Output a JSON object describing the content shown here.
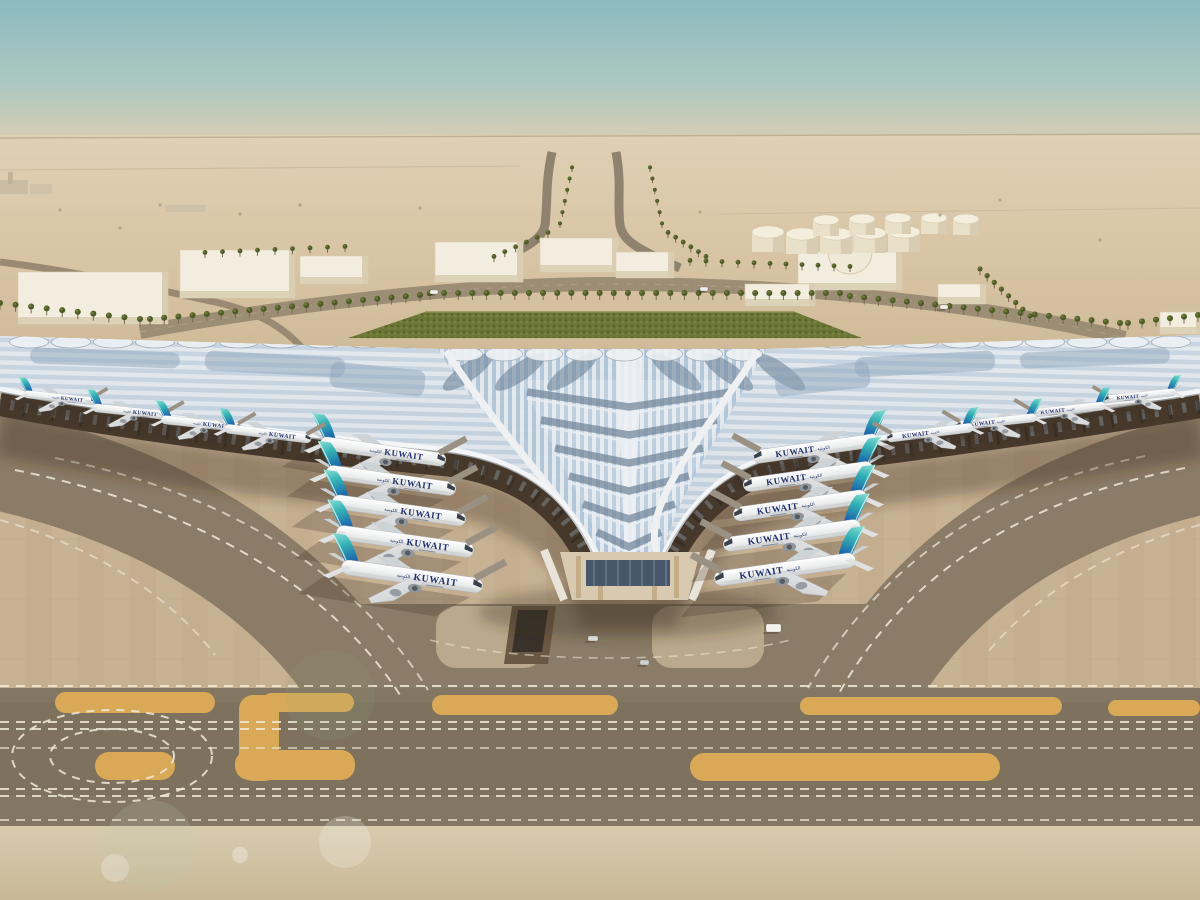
{
  "scene": {
    "title": "Aerial architectural rendering of Kuwait International Airport Terminal 2",
    "time_of_day": "day, hazy desert light",
    "view": "elevated aerial, terminal trefoil roof with aircraft at gates"
  },
  "colors": {
    "sky_top": "#8cbac0",
    "sky_horizon": "#ddd0b9",
    "desert_light": "#dfcfb2",
    "desert_mid": "#d2bd9c",
    "apron_light": "#c6b192",
    "apron_dark": "#8a7c66",
    "taxiway_band": "#837663",
    "paint_orange": "#d9a958",
    "marking_white": "#f0ead9",
    "roof_silver": "#e9edf0",
    "roof_glass_blue": "#a9c2dc",
    "roof_slate": "#6e8295",
    "tail_teal": "#35b3b6",
    "tail_blue": "#1d66ab",
    "livery_navy": "#20306d",
    "greenery": "#6c7636"
  },
  "aircraft": {
    "label": "KUWAIT",
    "label_arabic": "الكويتية",
    "fleets": [
      {
        "name": "left-gates",
        "dir": "right",
        "layer": "planes-main",
        "items": [
          {
            "x": 383,
            "y": 452,
            "r": 8,
            "s": 0.96
          },
          {
            "x": 391,
            "y": 481,
            "r": 8,
            "s": 0.99
          },
          {
            "x": 399,
            "y": 511,
            "r": 8,
            "s": 1.02
          },
          {
            "x": 405,
            "y": 542,
            "r": 8,
            "s": 1.05
          },
          {
            "x": 412,
            "y": 577,
            "r": 8,
            "s": 1.08
          }
        ]
      },
      {
        "name": "right-gates",
        "dir": "left",
        "layer": "planes-main",
        "items": [
          {
            "x": 816,
            "y": 449,
            "r": -8,
            "s": 0.96
          },
          {
            "x": 808,
            "y": 477,
            "r": -8,
            "s": 0.99
          },
          {
            "x": 800,
            "y": 506,
            "r": -8,
            "s": 1.02
          },
          {
            "x": 792,
            "y": 536,
            "r": -8,
            "s": 1.05
          },
          {
            "x": 785,
            "y": 570,
            "r": -8,
            "s": 1.08
          }
        ]
      },
      {
        "name": "left-underwing",
        "dir": "right",
        "layer": "planes-main",
        "items": [
          {
            "x": 60,
            "y": 398,
            "r": 6,
            "s": 0.55
          },
          {
            "x": 132,
            "y": 412,
            "r": 6,
            "s": 0.6
          },
          {
            "x": 202,
            "y": 424,
            "r": 6,
            "s": 0.62
          },
          {
            "x": 268,
            "y": 434,
            "r": 7,
            "s": 0.66
          }
        ]
      },
      {
        "name": "right-underwing",
        "dir": "left",
        "layer": "planes-main",
        "items": [
          {
            "x": 1140,
            "y": 396,
            "r": -6,
            "s": 0.55
          },
          {
            "x": 1066,
            "y": 410,
            "r": -6,
            "s": 0.6
          },
          {
            "x": 996,
            "y": 422,
            "r": -6,
            "s": 0.62
          },
          {
            "x": 930,
            "y": 433,
            "r": -7,
            "s": 0.66
          }
        ]
      },
      {
        "name": "tucked-left",
        "dir": "right",
        "layer": "planes-tucked",
        "items": [
          {
            "x": 472,
            "y": 432,
            "r": 8,
            "s": 0.85
          }
        ]
      },
      {
        "name": "tucked-right",
        "dir": "left",
        "layer": "planes-tucked",
        "items": [
          {
            "x": 726,
            "y": 430,
            "r": -8,
            "s": 0.85
          }
        ]
      }
    ]
  },
  "palms": {
    "rows": [
      {
        "x1": 0,
        "y1": 310,
        "x2": 140,
        "y2": 326,
        "n": 10,
        "r": 3
      },
      {
        "x1": 150,
        "y1": 326,
        "x2": 420,
        "y2": 302,
        "n": 20,
        "r": 3
      },
      {
        "x1": 430,
        "y1": 300,
        "x2": 840,
        "y2": 300,
        "n": 30,
        "r": 3
      },
      {
        "x1": 850,
        "y1": 303,
        "x2": 1120,
        "y2": 330,
        "n": 20,
        "r": 3
      },
      {
        "x1": 1128,
        "y1": 330,
        "x2": 1198,
        "y2": 322,
        "n": 6,
        "r": 3
      },
      {
        "x1": 548,
        "y1": 238,
        "x2": 494,
        "y2": 262,
        "n": 6,
        "r": 2.4
      },
      {
        "x1": 560,
        "y1": 228,
        "x2": 572,
        "y2": 172,
        "n": 6,
        "r": 2
      },
      {
        "x1": 668,
        "y1": 238,
        "x2": 706,
        "y2": 262,
        "n": 6,
        "r": 2.4
      },
      {
        "x1": 662,
        "y1": 228,
        "x2": 650,
        "y2": 172,
        "n": 6,
        "r": 2
      },
      {
        "x1": 690,
        "y1": 266,
        "x2": 850,
        "y2": 272,
        "n": 11,
        "r": 2.4
      },
      {
        "x1": 205,
        "y1": 258,
        "x2": 345,
        "y2": 252,
        "n": 9,
        "r": 2.4
      },
      {
        "x1": 980,
        "y1": 275,
        "x2": 1030,
        "y2": 322,
        "n": 8,
        "r": 2.6
      }
    ]
  },
  "shrubs": [
    [
      60,
      210
    ],
    [
      120,
      228
    ],
    [
      300,
      205
    ],
    [
      700,
      212
    ],
    [
      1000,
      200
    ],
    [
      1100,
      240
    ],
    [
      160,
      205
    ],
    [
      240,
      214
    ],
    [
      420,
      208
    ],
    [
      940,
      215
    ]
  ],
  "tanks": {
    "front": {
      "r": 16,
      "h": 20,
      "items": [
        [
          768,
          252
        ],
        [
          802,
          254
        ],
        [
          836,
          254
        ],
        [
          870,
          253
        ],
        [
          904,
          252
        ]
      ]
    },
    "back": {
      "r": 13,
      "h": 16,
      "items": [
        [
          826,
          236
        ],
        [
          862,
          235
        ],
        [
          898,
          234
        ],
        [
          934,
          234
        ],
        [
          966,
          235
        ]
      ]
    }
  },
  "buildings": [
    [
      18,
      272,
      150,
      52
    ],
    [
      180,
      250,
      115,
      48
    ],
    [
      300,
      256,
      68,
      28
    ],
    [
      435,
      242,
      88,
      40
    ],
    [
      540,
      238,
      78,
      34
    ],
    [
      616,
      252,
      58,
      26
    ],
    [
      798,
      252,
      104,
      38
    ],
    [
      745,
      284,
      70,
      22
    ],
    [
      938,
      284,
      48,
      20
    ],
    [
      1160,
      312,
      42,
      22
    ]
  ],
  "apron": {
    "islands": [
      [
        55,
        692,
        160,
        21
      ],
      [
        262,
        693,
        92,
        19
      ],
      [
        432,
        695,
        186,
        20
      ],
      [
        800,
        697,
        262,
        18
      ],
      [
        1108,
        700,
        92,
        16
      ],
      [
        95,
        752,
        80,
        28
      ],
      [
        235,
        750,
        120,
        30
      ],
      [
        690,
        753,
        310,
        28
      ],
      [
        239,
        695,
        40,
        86
      ]
    ]
  },
  "markings": {
    "dashed": [
      {
        "d": "M 0,686 H 1200"
      },
      {
        "d": "M 0,722 H 1200"
      },
      {
        "d": "M 0,729 H 1200"
      },
      {
        "d": "M 0,748 H 1200",
        "o": 0.6
      },
      {
        "d": "M 0,789 H 1200"
      },
      {
        "d": "M 0,796 H 1200"
      },
      {
        "d": "M 0,820 H 1200",
        "o": 0.7
      },
      {
        "d": "M 15,470 C 190,505 330,585 400,695"
      },
      {
        "d": "M 55,458 C 225,492 355,572 428,690",
        "o": 0.7
      },
      {
        "d": "M 1185,468 C 1020,500 905,575 838,695"
      },
      {
        "d": "M 1145,456 C 990,488 880,565 808,688",
        "o": 0.7
      },
      {
        "d": "M 0,520 C 90,545 170,595 215,655",
        "o": 0.6
      },
      {
        "d": "M 1200,525 C 1110,548 1035,595 988,652",
        "o": 0.6
      },
      {
        "d": "M 430,640 C 520,664 700,664 790,640",
        "o": 0.55,
        "w": 1.6
      }
    ],
    "loops": [
      {
        "cx": 112,
        "cy": 756,
        "rx": 100,
        "ry": 46
      },
      {
        "cx": 112,
        "cy": 756,
        "rx": 62,
        "ry": 27
      }
    ]
  },
  "roof": {
    "chevron_ys": [
      392,
      420,
      448,
      476,
      504,
      532
    ],
    "leaf_xs": [
      468,
      520,
      572,
      676,
      728,
      780
    ],
    "patches": [
      [
        30,
        350,
        150,
        16,
        2
      ],
      [
        205,
        354,
        140,
        20,
        3
      ],
      [
        330,
        366,
        95,
        26,
        6
      ],
      [
        1020,
        350,
        150,
        16,
        -2
      ],
      [
        855,
        354,
        140,
        20,
        -3
      ],
      [
        775,
        366,
        95,
        26,
        -6
      ]
    ],
    "scallop_rows": [
      {
        "x0": 8,
        "x1": 436,
        "y": 342,
        "step": 42,
        "ry": 6
      },
      {
        "x0": 444,
        "x1": 764,
        "y": 354,
        "step": 40,
        "ry": 7
      },
      {
        "x0": 772,
        "x1": 1196,
        "y": 342,
        "step": 42,
        "ry": 6
      }
    ]
  },
  "vehicles": [
    {
      "x": 766,
      "y": 624,
      "w": 15,
      "h": 8,
      "c": "#f4f2ec"
    },
    {
      "x": 588,
      "y": 636,
      "w": 10,
      "h": 5,
      "c": "#d8dcd4"
    },
    {
      "x": 640,
      "y": 660,
      "w": 9,
      "h": 5,
      "c": "#cfd3cf"
    },
    {
      "x": 430,
      "y": 290,
      "w": 8,
      "h": 4,
      "c": "#f2f2ee"
    },
    {
      "x": 700,
      "y": 287,
      "w": 8,
      "h": 4,
      "c": "#eceff0"
    },
    {
      "x": 940,
      "y": 305,
      "w": 8,
      "h": 4,
      "c": "#f2f2ee"
    }
  ]
}
